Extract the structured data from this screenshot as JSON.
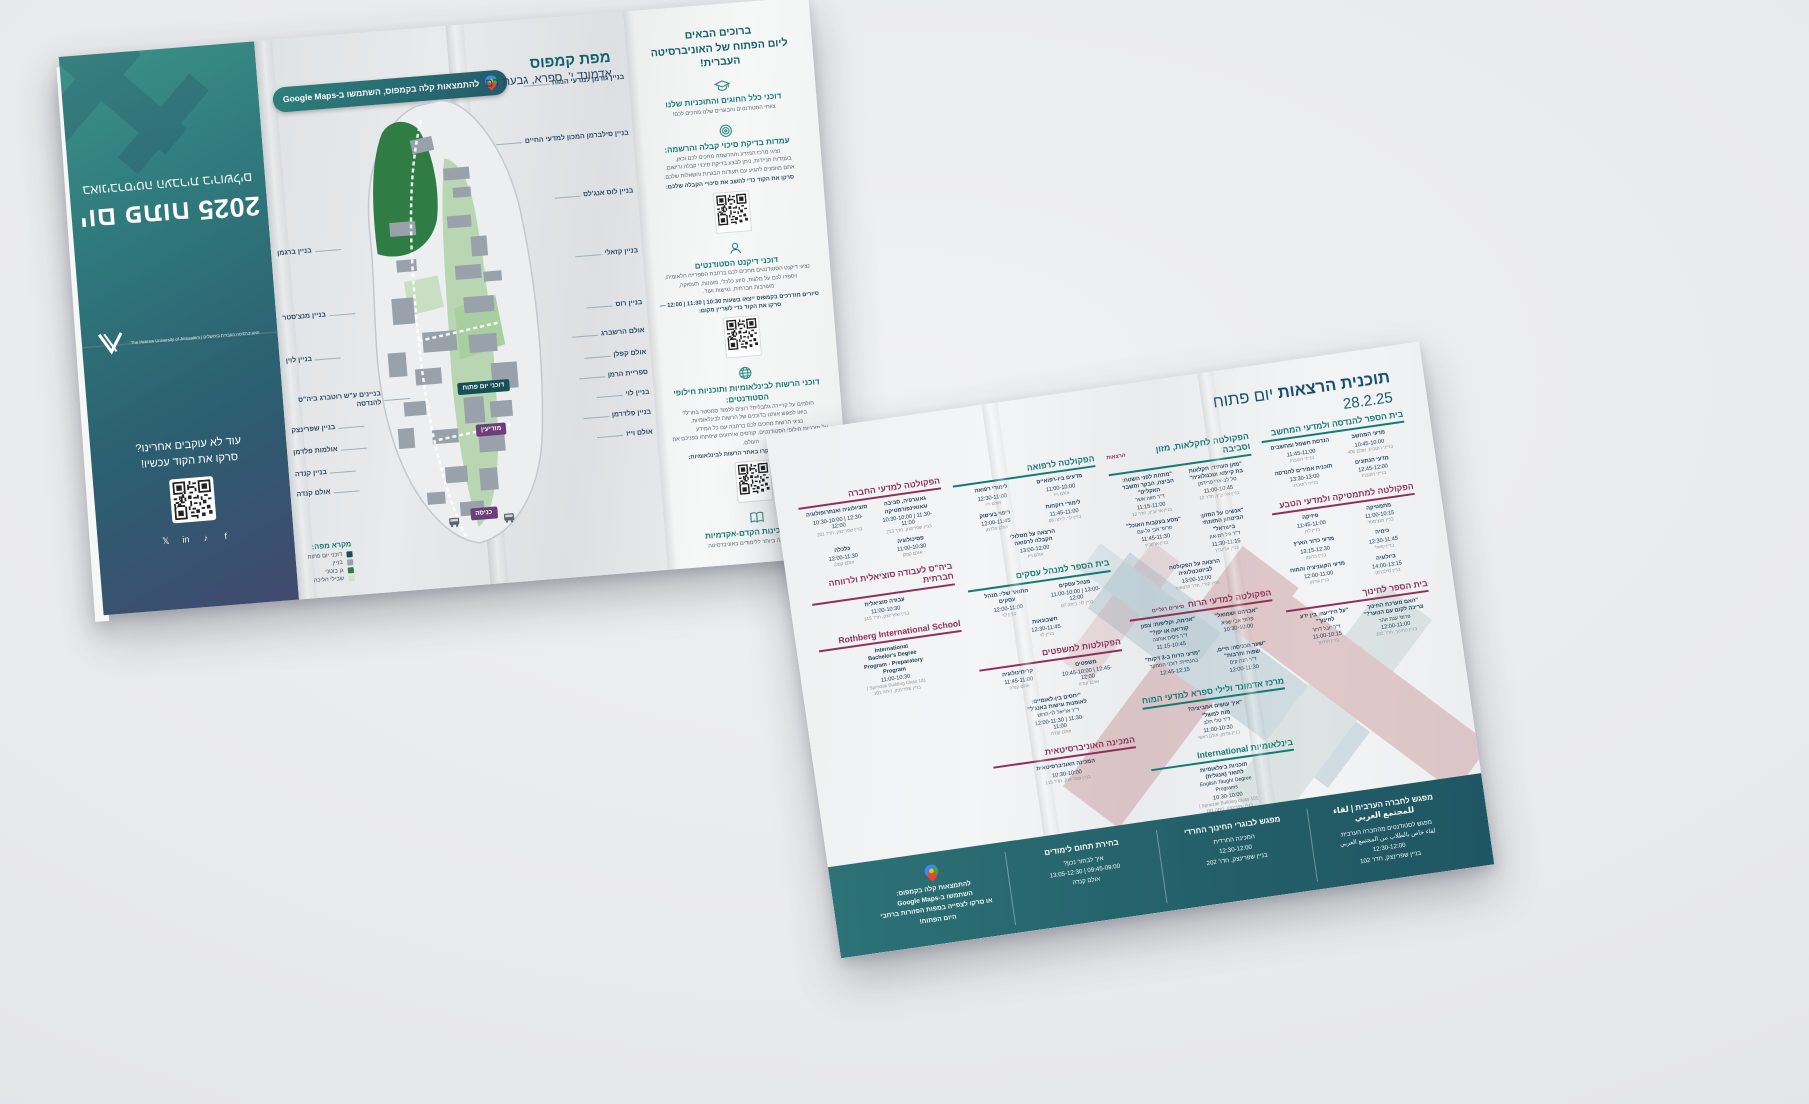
{
  "left_brochure": {
    "back_panel": {
      "title": "יום פתוח 2025",
      "subtitle": "באוניברסיטה העברית בירושלים",
      "logo_text": "האוניברסיטה העברית בירושלים | The Hebrew University of Jerusalem",
      "follow_line1": "עוד לא עוקבים אחרינו?",
      "follow_line2": "סרקו את הקוד עכשיו!",
      "socials": [
        "f",
        "♪",
        "in",
        "𝕏"
      ]
    },
    "map_panel": {
      "maps_badge": "להתמצאות קלה בקמפוס, השתמשו ב-Google Maps",
      "title": "מפת קמפוס",
      "subtitle": "אדמונד י'. ספרא, גבעת רם",
      "badges": {
        "open_day": "דוכני יום פתוח",
        "info": "מודיעין",
        "entrance": "כניסה"
      },
      "labels_right": [
        "בניין גודמן למדעי המוח",
        "בניין סילברמן המכון למדעי החיים",
        "בניין לוס אנג'לס",
        "בניין קזאלי",
        "בניין רוס",
        "אולם הרשברג",
        "אולם קפלן",
        "ספריית הרמן",
        "בניין לוי",
        "בניין פלדרמן",
        "אולם וייז"
      ],
      "labels_left": [
        "בניין ברגמן",
        "בניין מנצ'סטר",
        "בניין לוין",
        "בניינים ע\"ש רוטברג ביה\"ס להנדסה",
        "בניין שפרינצק",
        "אולמות פלדמן",
        "בניין קנדה",
        "אולם קנדה"
      ],
      "legend": {
        "title": "מקרא מפה:",
        "items": [
          {
            "color": "#174f57",
            "label": "דוכני יום פתוח"
          },
          {
            "color": "#99a1ab",
            "label": "בניין"
          },
          {
            "color": "#2f7d44",
            "label": "גן בוטני"
          },
          {
            "color": "#cfe0cb",
            "label": "שבילי הליכה"
          }
        ]
      }
    },
    "info_panel": {
      "welcome_line1": "ברוכים הבאים",
      "welcome_line2": "ליום הפתוח של האוניברסיטה העברית!",
      "sections": [
        {
          "icon": "cap",
          "qr": "no",
          "title": "דוכני כלל החוגים והתוכניות שלנו",
          "body": [
            "צוותי הסטודנטים והבוגרים שלנו מחכים לכם!"
          ],
          "bold": ""
        },
        {
          "icon": "target",
          "qr": "yes",
          "title": "עמדות בדיקת סיכוי קבלה והרשמה:",
          "body": [
            "נציגי מרכז המידע וההרשמה מחכים לכם וכאן,",
            "בעמדות הניידות, ניתן לבצע בדיקת סיכויי קבלה ורישום.",
            "אתם מוזמנים להגיע עם תעודות הבגרות והשאלות שלכם."
          ],
          "bold": "סרקו את הקוד כדי לחשב את סיכויי הקבלה שלכם:"
        },
        {
          "icon": "dean",
          "qr": "yes",
          "title": "דוכני דיקנט הסטודנטים",
          "body": [
            "נציגי דיקנט הסטודנטים מחכים לכם ברחבת הספרייה הלאומית,",
            "ויספרו לכם על מלגות, סיוע כלכלי, מעונות, תעסוקה,",
            "מעורבות חברתית, נגישות ועוד."
          ],
          "bold": "סיורים מודרכים בקמפוס ייצאו בשעות 10:30 | 11:30 | 12:00 — סרקו את הקוד כדי לשריין מקום:"
        },
        {
          "icon": "globe",
          "qr": "yes",
          "title": "דוכני הרשות לבינלאומיות ותוכניות חילופי הסטודנטים:",
          "body": [
            "חולמים על קריירה גלובלית? רוצים ללמוד סמסטר בחו\"ל?",
            "בואו לפגוש אותנו בדוכנים של הרשות לבינלאומיות.",
            "נציגי הרשות מחכים לכם ברחבה עם כל המידע",
            "על תוכניות חילופי הסטודנטים, קורסים ואירועים שיפתחו בפניכם את העולם."
          ],
          "bold": "לפרטים נוספים, בקרו באתר הרשות לבינלאומיות:"
        },
        {
          "icon": "book",
          "qr": "no",
          "title": "דוכני המכינות הקדם-אקדמיות",
          "body": [
            "ההכנה הטובה ביותר ללימודים באוניברסיטה"
          ],
          "bold": ""
        }
      ]
    }
  },
  "schedule_brochure": {
    "title_bold": "תוכנית הרצאות",
    "title_rest": "יום פתוח",
    "date": "28.2.25",
    "columns": [
      {
        "sections": [
          {
            "accent": "teal",
            "title": "בית הספר להנדסה ולמדעי המחשב",
            "note": "",
            "entries": [
              {
                "t": "מדעי המחשב",
                "sp": "",
                "tm": "10:45-10:00",
                "rm": "בנייני רוטברג, אולם 405"
              },
              {
                "t": "הנדסת חשמל ומחשבים",
                "sp": "",
                "tm": "11:45-11:00",
                "rm": "בנייני רוטברג"
              },
              {
                "t": "מדעי הנתונים",
                "sp": "",
                "tm": "12:45-12:00",
                "rm": "בנייני רוטברג"
              },
              {
                "t": "תוכנית אמירים להנדסה",
                "sp": "",
                "tm": "13:30-13:00",
                "rm": "בנייני רוטברג"
              }
            ]
          },
          {
            "accent": "maroon",
            "title": "הפקולטה למתמטיקה ולמדעי הטבע",
            "note": "",
            "entries": [
              {
                "t": "מתמטיקה",
                "sp": "",
                "tm": "11:00-10:15",
                "rm": "בניין מנצ'סטר"
              },
              {
                "t": "פיזיקה",
                "sp": "",
                "tm": "11:45-11:00",
                "rm": "בניין לוין"
              },
              {
                "t": "כימיה",
                "sp": "",
                "tm": "12:30-11:45",
                "rm": "בניין קזאלי"
              },
              {
                "t": "מדעי כדור הארץ",
                "sp": "",
                "tm": "13:15-12:30",
                "rm": "בניין ברגמן"
              },
              {
                "t": "ביולוגיה",
                "sp": "",
                "tm": "14:00-13:15",
                "rm": "בניין סילברמן"
              },
              {
                "t": "מדעי הקוגניציה והמוח",
                "sp": "",
                "tm": "12:00-11:00",
                "rm": "בניין גודמן"
              }
            ]
          },
          {
            "accent": "maroon",
            "title": "בית הספר לחינוך",
            "note": "",
            "entries": [
              {
                "t": "\"האם מערכת החינוך צריכה לקום עם הנוער?\"",
                "sp": "פרופ' ענת זוהר",
                "tm": "12:00-11:00",
                "rm": "בניין החינוך, חדר 102"
              },
              {
                "t": "\"על הידיעה: בין ידע לחינוך\"",
                "sp": "ד\"ר יובל דרור",
                "tm": "11:00-10:15",
                "rm": "בניין החינוך"
              }
            ]
          }
        ]
      },
      {
        "sections": [
          {
            "accent": "teal",
            "title": "הפקולטה לחקלאות, מזון וסביבה",
            "note": "הרצאות",
            "entries": [
              {
                "t": "\"מזון העתיד: חקלאות בת קיימא וטכנולוגיה\"",
                "sp": "טל לב-ארי פרידמן",
                "tm": "11:00-10:45",
                "rm": "בניין אריוביץ, חדר 12"
              },
              {
                "t": "\"מתחת לפני השטח: הביצה, הבקר ומשבר האקלים\"",
                "sp": "ד\"ר חווה אשר",
                "tm": "11:15-11:00",
                "rm": "בניין אריוביץ, חדר 12"
              },
              {
                "t": "\"אנשים על המזון: הביטחון התזונתי בישראל\"",
                "sp": "ד\"ר גיל רם-און",
                "tm": "11:30-11:15",
                "rm": "בניין אריוביץ"
              },
              {
                "t": "\"מסע בעקבות האוכל\"",
                "sp": "פרופ' אבי גל-עם",
                "tm": "11:45-11:30",
                "rm": "בניין אריוביץ"
              },
              {
                "t": "הרצאה על הפקולטה לביוטכנולוגיה",
                "sp": "",
                "tm": "13:00-12:00",
                "rm": "בניין קנדי, חדר הרצאות"
              }
            ]
          },
          {
            "accent": "maroon",
            "title": "הפקולטה למדעי הרוח",
            "note": "סיורים רגליים",
            "entries": [
              {
                "t": "\"אברהם ושמואל\"",
                "sp": "פרופ' אבי שגיא",
                "tm": "10:30-10:00",
                "rm": ""
              },
              {
                "t": "\"אנימה, וקליפות: צפון קוריאה או יפן?\"",
                "sp": "ד\"ר ניסים אוחנה",
                "tm": "11:15-10:45",
                "rm": ""
              },
              {
                "t": "\"שער הכניסה: חיים, שפות ותרבות\"",
                "sp": "ד\"ר חנה קים",
                "tm": "12:00-11:30",
                "rm": ""
              },
              {
                "t": "\"מדעי הרוח ב-3 דקות\"",
                "sp": "בהנחיית: דוכני המחקר",
                "tm": "12:45-12:15",
                "rm": ""
              }
            ]
          },
          {
            "accent": "teal",
            "title": "מרכז אדמונד ולילי ספרא למדעי המוח",
            "note": "",
            "entries": [
              {
                "t": "\"איך עושים אמביציה? מוח למשל\"",
                "sp": "ד\"ר טלי חלב",
                "tm": "11:00-10:30",
                "rm": "בניין גודמן, אולם ראשי"
              }
            ]
          },
          {
            "accent": "teal",
            "title": "בינלאומיות International",
            "note": "",
            "entries": [
              {
                "t": "תוכניות בינלאומיות לתואר (אנגלית)",
                "sp": "English Taught Degree Programs",
                "tm": "10:30-10:00",
                "rm": "Sprinzak Building Class 101 | בניין שפרינצק, כיתה 101"
              }
            ]
          }
        ]
      },
      {
        "sections": [
          {
            "accent": "teal",
            "title": "הפקולטה לרפואה",
            "note": "",
            "entries": [
              {
                "t": "מדעים ביו-רפואיים",
                "sp": "",
                "tm": "11:00-10:00",
                "rm": "אולם וייז"
              },
              {
                "t": "לימודי רפואה",
                "sp": "",
                "tm": "12:30-11:00",
                "rm": "אולם וייז"
              },
              {
                "t": "לימודי רוקחות",
                "sp": "",
                "tm": "11:45-11:00",
                "rm": "בניין לוי, כיתה 06"
              },
              {
                "t": "ריפוי בעיסוק",
                "sp": "",
                "tm": "12:00-11:45",
                "rm": "אולם פלדמן"
              },
              {
                "t": "הרצאה על מסלולי הקבלה לרפואה",
                "sp": "",
                "tm": "13:00-12:00",
                "rm": "אולם וייז"
              }
            ]
          },
          {
            "accent": "teal",
            "title": "בית הספר למנהל עסקים",
            "note": "",
            "entries": [
              {
                "t": "מנהל עסקים",
                "sp": "",
                "tm": "11:00-10:00 | 13:00-12:00",
                "rm": "בניין לוי, כיתה 07"
              },
              {
                "t": "התואר שלי: מנהל עסקים",
                "sp": "",
                "tm": "12:00-11:00",
                "rm": "בניין לוי"
              },
              {
                "t": "חשבונאות",
                "sp": "",
                "tm": "12:30-11:45",
                "rm": "בניין לוי"
              }
            ]
          },
          {
            "accent": "maroon",
            "title": "הפקולטות למשפטים",
            "note": "",
            "entries": [
              {
                "t": "משפטים",
                "sp": "",
                "tm": "10:45-10:00 | 12:45-12:00",
                "rm": "אולם קנדה"
              },
              {
                "t": "קרימינולוגיה",
                "sp": "",
                "tm": "11:45-11:00",
                "rm": "אולם קנדה"
              },
              {
                "t": "\"יחסים בין-לאומיים: לאומנות וגישות באנג'ל\"",
                "sp": "ד\"ר אריאל לוי-הרוש",
                "tm": "12:00-11:30 | 11:30-11:00",
                "rm": "אולם קנדה"
              }
            ]
          },
          {
            "accent": "maroon",
            "title": "המכינה האוניברסיטאית",
            "note": "",
            "entries": [
              {
                "t": "המכינה האוניברסיטאית",
                "sp": "",
                "tm": "10:30-10:00",
                "rm": "בניין שפרינצק, חדר 115"
              }
            ]
          }
        ]
      },
      {
        "sections": [
          {
            "accent": "maroon",
            "title": "הפקולטה למדעי החברה",
            "note": "",
            "entries": [
              {
                "t": "גאוגרפיה, סביבה וגאואינפורמטיקה",
                "sp": "",
                "tm": "10:30-10:00 | 11:30-11:00",
                "rm": "בניין שפרינצק, חדר 213"
              },
              {
                "t": "סוציולוגיה ואנתרופולוגיה",
                "sp": "",
                "tm": "10:30-10:00 | 12:30-12:00",
                "rm": "בניין שפרינצק, חדר 201"
              },
              {
                "t": "פסיכולוגיה",
                "sp": "",
                "tm": "11:00-10:30",
                "rm": "אולם קפלן"
              },
              {
                "t": "כלכלה",
                "sp": "",
                "tm": "12:00-11:30",
                "rm": "אולם קפלן"
              }
            ]
          },
          {
            "accent": "maroon",
            "title": "ביה\"ס לעבודה סוציאלית ולרווחה חברתית",
            "note": "",
            "entries": [
              {
                "t": "עבודה סוציאלית",
                "sp": "",
                "tm": "11:00-10:30",
                "rm": "בניין שפרינצק, חדר 115"
              }
            ]
          },
          {
            "accent": "maroon",
            "title": "Rothberg International School",
            "note": "",
            "entries": [
              {
                "t": "International Bachelor's Degree Program - Preparatory Program",
                "sp": "",
                "tm": "11:00-10:30",
                "rm": "Sprinzak Building Class 101 | בניין שפרינצק, כיתה 101"
              }
            ]
          }
        ]
      }
    ],
    "band": [
      {
        "kind": "text",
        "heading": "מפגש לחברה הערבית | لقاء للمجتمع العربي",
        "lines": [
          "מפגש לסטודנטים מהחברה הערבית",
          "لقاء خاص بالطلاب من المجتمع العربي",
          "12:30-12:00",
          "בניין שפרינצק, חדר 102"
        ]
      },
      {
        "kind": "text",
        "heading": "מפגש לבוגרי החינוך החרדי",
        "lines": [
          "המכינה החרדית",
          "12:30-12:00",
          "בניין שפרינצק, חדר 202"
        ]
      },
      {
        "kind": "text",
        "heading": "בחירת תחום לימודים",
        "lines": [
          "איך לבחור נכון?",
          "09:45-09:00 | 13:05-12:30",
          "אולם קנדה"
        ]
      },
      {
        "kind": "maps",
        "heading": "",
        "lines": [
          "להתמצאות קלה בקמפוס:",
          "השתמשו ב-Google Maps",
          "או סרקו לצפייה במפות הפזורות ברחבי היום הפתוח!"
        ]
      }
    ]
  }
}
